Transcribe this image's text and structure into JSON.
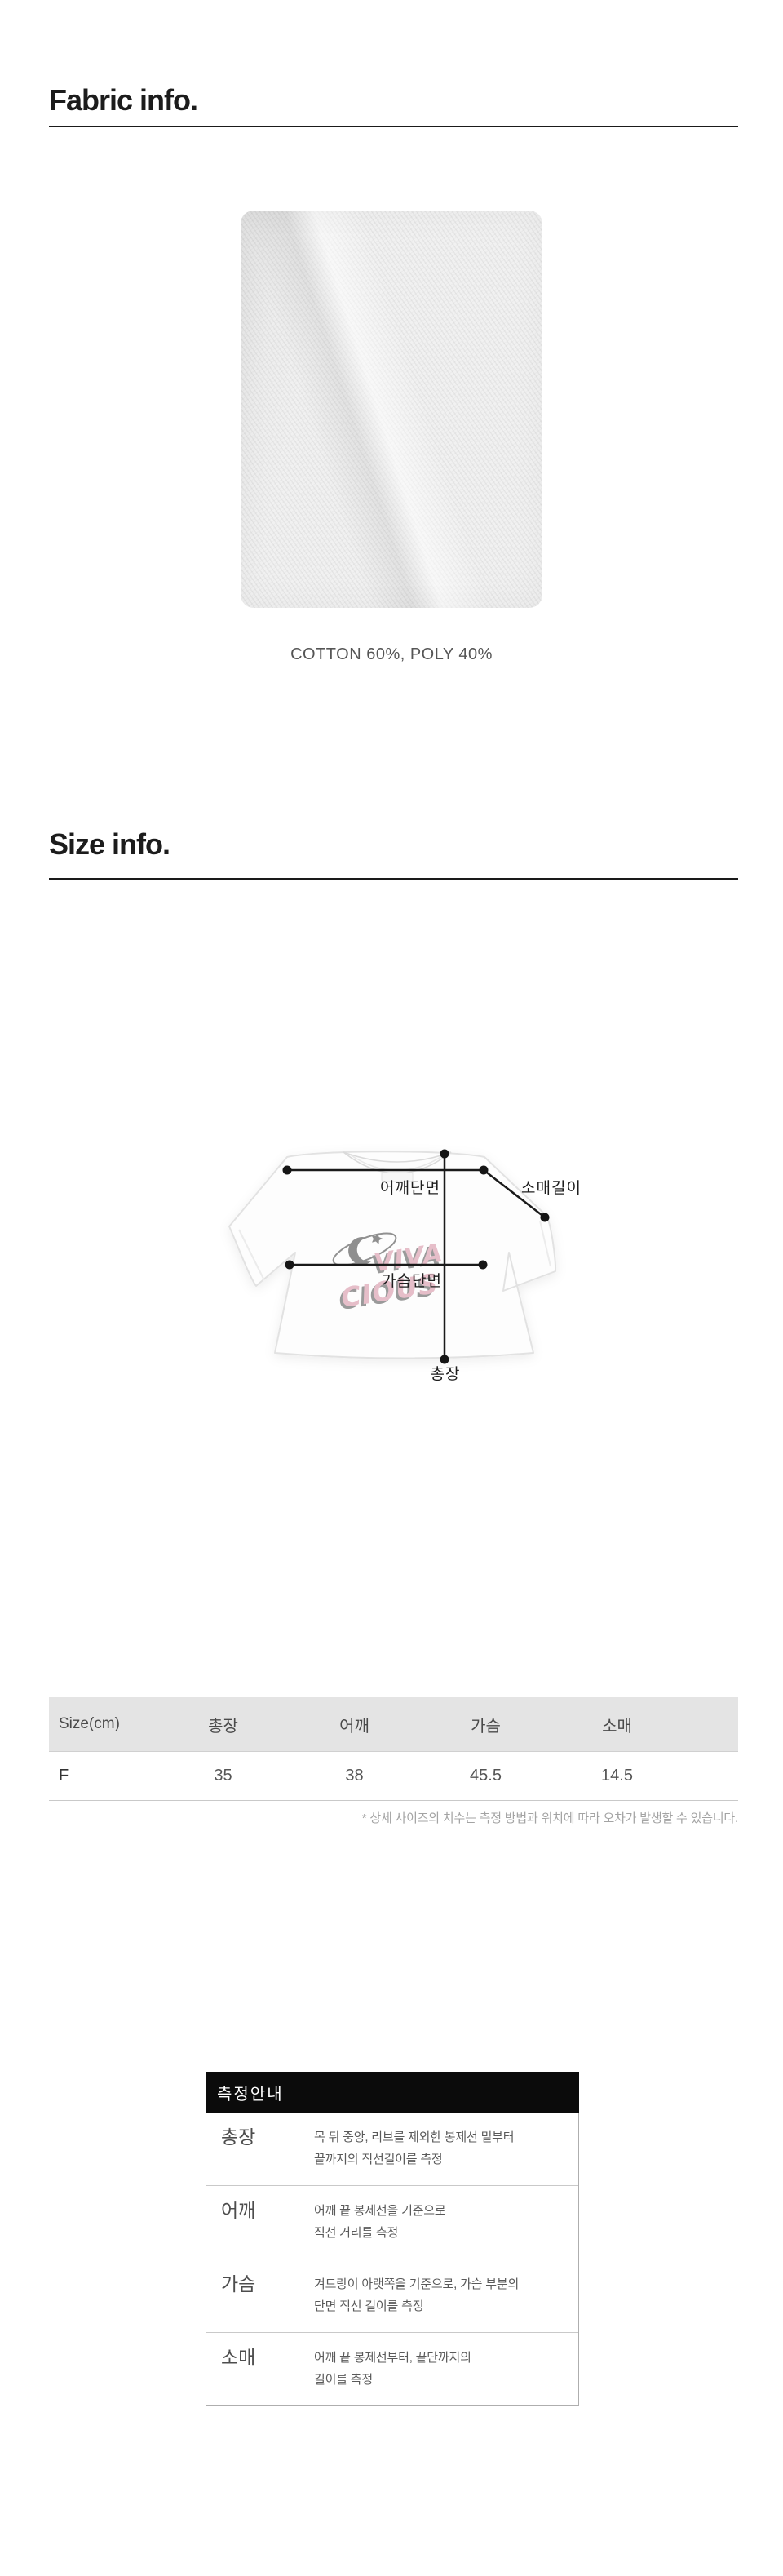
{
  "fabric_section": {
    "title": "Fabric info.",
    "caption": "COTTON 60%, POLY 40%"
  },
  "size_section": {
    "title": "Size info.",
    "diagram": {
      "labels": {
        "shoulder": "어깨단면",
        "sleeve": "소매길이",
        "chest": "가슴단면",
        "length": "총장"
      },
      "watermark": {
        "line1": "VIVA",
        "line2": "CIOUS",
        "pink": "#e6bec9",
        "shadow_gray": "#9a9a9a"
      }
    }
  },
  "size_table": {
    "headers": [
      "Size(cm)",
      "총장",
      "어깨",
      "가슴",
      "소매"
    ],
    "rows": [
      [
        "F",
        "35",
        "38",
        "45.5",
        "14.5"
      ]
    ],
    "footnote": "* 상세 사이즈의 치수는 측정 방법과 위치에 따라 오차가 발생할 수 있습니다.",
    "header_bg": "#e4e4e4"
  },
  "measure_guide": {
    "title": "측정안내",
    "header_bg": "#0b0b0b",
    "rows": [
      {
        "label": "총장",
        "desc_line1": "목 뒤 중앙, 리브를 제외한 봉제선 밑부터",
        "desc_line2": "끝까지의 직선길이를 측정"
      },
      {
        "label": "어깨",
        "desc_line1": "어깨 끝 봉제선을 기준으로",
        "desc_line2": "직선 거리를 측정"
      },
      {
        "label": "가슴",
        "desc_line1": "겨드랑이 아랫쪽을 기준으로, 가슴 부분의",
        "desc_line2": "단면 직선 길이를 측정"
      },
      {
        "label": "소매",
        "desc_line1": "어깨 끝 봉제선부터, 끝단까지의",
        "desc_line2": "길이를 측정"
      }
    ]
  }
}
